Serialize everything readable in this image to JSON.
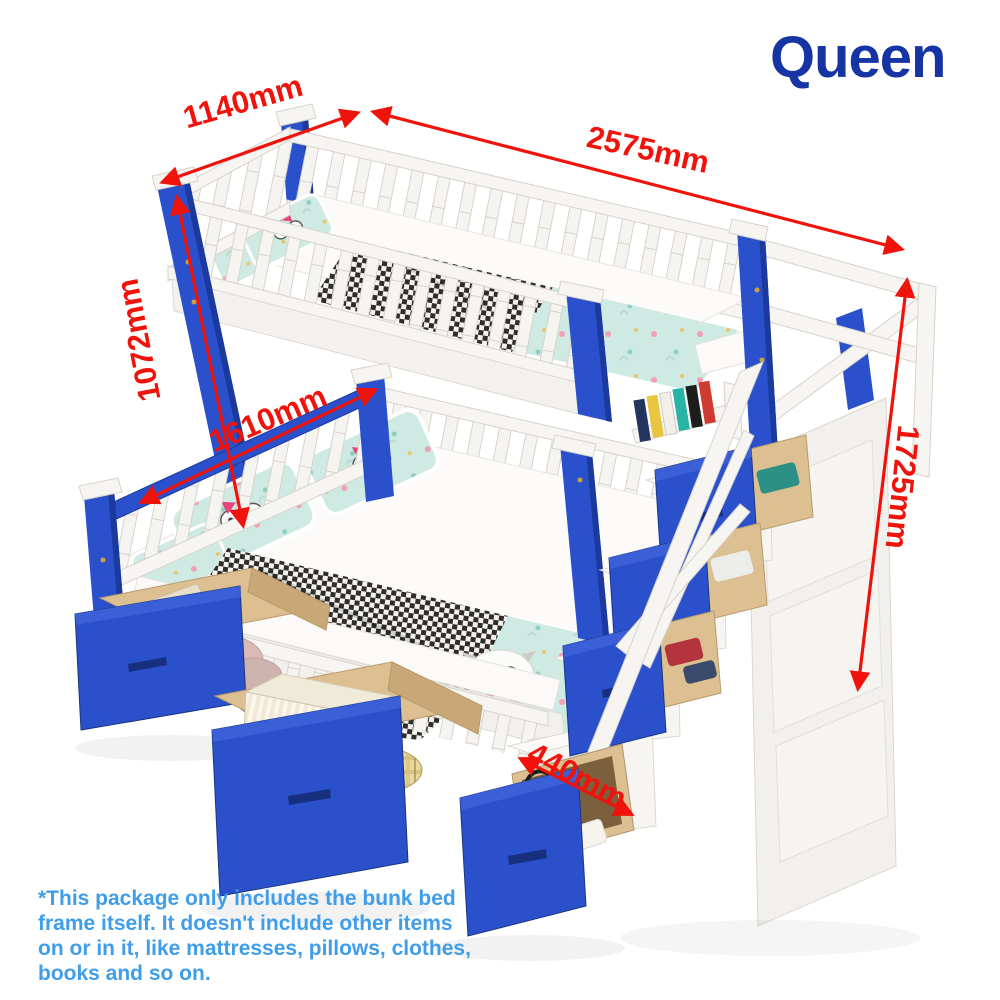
{
  "header": {
    "title": "Queen"
  },
  "dimensions": {
    "top_width": {
      "label": "1140mm"
    },
    "total_length": {
      "label": "2575mm"
    },
    "upper_bunk_height": {
      "label": "1072mm"
    },
    "lower_width": {
      "label": "1610mm"
    },
    "total_height": {
      "label": "1725mm"
    },
    "stair_depth": {
      "label": "440mm"
    }
  },
  "disclaimer": {
    "lines": [
      "*This package only includes the bunk bed",
      "frame itself. It doesn't include other items",
      "on or in it, like mattresses, pillows, clothes,",
      "books and so on."
    ]
  },
  "colors": {
    "accent_red": "#ef130b",
    "brand_blue": "#1734a4",
    "note_blue": "#3f9de9",
    "bed_blue": "#2a50cb",
    "bed_blue_dark": "#1c3a9e",
    "frame_white": "#f6f5f2",
    "wood": "#dcc091",
    "bedding_mint": "#cfeae3"
  }
}
